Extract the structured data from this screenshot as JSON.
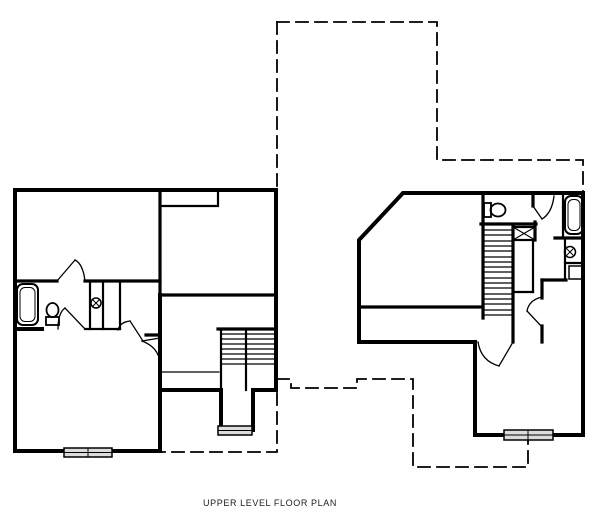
{
  "title": {
    "label": "UPPER LEVEL FLOOR PLAN"
  },
  "canvas": {
    "width": 600,
    "height": 528,
    "background": "#ffffff",
    "line_color": "#000000",
    "window_fill": "#dcdcdc"
  },
  "drawing": {
    "layers": [
      {
        "name": "lower-level-dashed-outline",
        "stroke": "#000000",
        "width": 1.8,
        "dash": "12 7",
        "items": [
          {
            "d": "M277,22 H437 V160 H583 V192"
          },
          {
            "d": "M277,22 V189"
          },
          {
            "d": "M277,379 H291 V388 H357 V379 H413 V467 H528 V441"
          },
          {
            "d": "M277,393 V452 H162"
          }
        ]
      },
      {
        "name": "exterior-walls",
        "stroke": "#000000",
        "width": 4,
        "items": [
          {
            "d": "M15,190 H276 V390 H253"
          },
          {
            "d": "M253,390 V430"
          },
          {
            "d": "M221,390 V430"
          },
          {
            "d": "M219,390 H160"
          },
          {
            "d": "M160,295 V451"
          },
          {
            "d": "M160,451 H15 V190"
          },
          {
            "d": "M403,193 L583,193 L583,435 L475,435 L475,342 L359,342 L359,240 Z"
          },
          {
            "d": "M15,329 H42"
          }
        ]
      },
      {
        "name": "interior-walls",
        "stroke": "#000000",
        "width": 3.2,
        "items": [
          {
            "d": "M160,190 V338"
          },
          {
            "d": "M160,295 H276"
          },
          {
            "d": "M15,281 H57"
          },
          {
            "d": "M85,281 H160"
          },
          {
            "d": "M218,329 H276"
          },
          {
            "d": "M146,335 H160"
          },
          {
            "d": "M481,224 H536"
          },
          {
            "d": "M483,193 V318"
          },
          {
            "d": "M513,227 V342"
          },
          {
            "d": "M359,307 H483"
          },
          {
            "d": "M542,280 V298"
          },
          {
            "d": "M542,326 V342"
          },
          {
            "d": "M542,280 H566"
          },
          {
            "d": "M555,238 H583"
          },
          {
            "d": "M533,193 V206"
          },
          {
            "d": "M535,222 V240"
          }
        ]
      },
      {
        "name": "partition-walls",
        "stroke": "#000000",
        "width": 2.2,
        "items": [
          {
            "d": "M162,206 H218 V193"
          },
          {
            "d": "M90,281 V329"
          },
          {
            "d": "M103,281 V329"
          },
          {
            "d": "M120,281 V329"
          },
          {
            "d": "M85,329 H120"
          },
          {
            "d": "M221,329 V390"
          },
          {
            "d": "M246,329 V390"
          },
          {
            "d": "M563,195 V237"
          },
          {
            "d": "M565,240 V280"
          },
          {
            "d": "M565,263 H583"
          },
          {
            "d": "M533,240 V292"
          },
          {
            "d": "M513,292 H533"
          }
        ]
      },
      {
        "name": "stair-treads",
        "stroke": "#000000",
        "width": 1.2,
        "items": [
          {
            "d": "M221,334 H246"
          },
          {
            "d": "M221,339 H246"
          },
          {
            "d": "M221,344 H246"
          },
          {
            "d": "M221,349 H246"
          },
          {
            "d": "M221,354 H246"
          },
          {
            "d": "M221,359 H246"
          },
          {
            "d": "M221,364 H246"
          },
          {
            "d": "M246,334 H276"
          },
          {
            "d": "M246,339 H276"
          },
          {
            "d": "M246,344 H276"
          },
          {
            "d": "M246,349 H276"
          },
          {
            "d": "M246,354 H276"
          },
          {
            "d": "M246,359 H276"
          },
          {
            "d": "M246,364 H276"
          },
          {
            "d": "M162,372 H219"
          },
          {
            "d": "M483,230 H513"
          },
          {
            "d": "M483,235 H513"
          },
          {
            "d": "M483,241 H513"
          },
          {
            "d": "M483,246 H513"
          },
          {
            "d": "M483,251 H513"
          },
          {
            "d": "M483,257 H513"
          },
          {
            "d": "M483,262 H513"
          },
          {
            "d": "M483,267 H513"
          },
          {
            "d": "M483,272 H513"
          },
          {
            "d": "M483,278 H513"
          },
          {
            "d": "M483,283 H513"
          },
          {
            "d": "M483,288 H513"
          },
          {
            "d": "M483,294 H513"
          },
          {
            "d": "M483,299 H513"
          },
          {
            "d": "M483,304 H513"
          },
          {
            "d": "M483,310 H513"
          },
          {
            "d": "M483,315 H513"
          }
        ]
      },
      {
        "name": "door-swings",
        "stroke": "#000000",
        "width": 1.3,
        "items": [
          {
            "d": "M57,281 L75,260"
          },
          {
            "d": "M75,260 Q83,264 85,281"
          },
          {
            "d": "M85,329 L65,308"
          },
          {
            "d": "M65,308 Q58,313 58,329"
          },
          {
            "d": "M118,330 Q120,322 130,321"
          },
          {
            "d": "M130,321 L143,341"
          },
          {
            "d": "M160,338 L142,341"
          },
          {
            "d": "M142,341 Q158,347 160,362"
          },
          {
            "d": "M478,342 Q481,361 499,366"
          },
          {
            "d": "M499,366 L513,342"
          },
          {
            "d": "M542,297 Q529,300 527,311"
          },
          {
            "d": "M527,311 L542,327"
          },
          {
            "d": "M533,206 L542,219"
          },
          {
            "d": "M542,219 Q552,213 554,196"
          }
        ]
      },
      {
        "name": "attic-access-x-box",
        "stroke": "#000000",
        "width": 2.2,
        "items": [
          {
            "kind": "rect",
            "x": 513,
            "y": 227,
            "w": 22,
            "h": 13
          },
          {
            "d": "M513,227 L535,240",
            "width": 1.1
          },
          {
            "d": "M513,240 L535,227",
            "width": 1.1
          }
        ]
      },
      {
        "name": "bath-fixtures",
        "stroke": "#000000",
        "width": 2,
        "items": [
          {
            "kind": "rect",
            "x": 17,
            "y": 284,
            "w": 21,
            "h": 41,
            "rx": 6
          },
          {
            "kind": "rect",
            "x": 20,
            "y": 287.5,
            "w": 15,
            "h": 34,
            "rx": 5,
            "width": 1
          },
          {
            "kind": "rect",
            "x": 565,
            "y": 196,
            "w": 18,
            "h": 38,
            "rx": 6
          },
          {
            "kind": "rect",
            "x": 568,
            "y": 199.5,
            "w": 12,
            "h": 31,
            "rx": 5,
            "width": 1
          },
          {
            "kind": "rect",
            "x": 46,
            "y": 317,
            "w": 13,
            "h": 8,
            "width": 1.8
          },
          {
            "kind": "ellipse",
            "cx": 52.5,
            "cy": 310,
            "rx": 6,
            "ry": 7,
            "width": 1.8
          },
          {
            "kind": "rect",
            "x": 484,
            "y": 203,
            "w": 7,
            "h": 14,
            "width": 1.8
          },
          {
            "kind": "ellipse",
            "cx": 498,
            "cy": 210,
            "rx": 7.5,
            "ry": 6.5,
            "width": 1.8
          },
          {
            "kind": "circle",
            "cx": 96,
            "cy": 303,
            "r": 5,
            "width": 1.5
          },
          {
            "d": "M93,300 L99,306",
            "width": 1
          },
          {
            "d": "M99,300 L93,306",
            "width": 1
          },
          {
            "kind": "circle",
            "cx": 570,
            "cy": 252,
            "r": 5.5,
            "width": 1.5
          },
          {
            "d": "M567,249 L573,255",
            "width": 1
          },
          {
            "d": "M573,249 L567,255",
            "width": 1
          },
          {
            "kind": "rect",
            "x": 569,
            "y": 266,
            "w": 13,
            "h": 13,
            "width": 1.5
          }
        ]
      },
      {
        "name": "windows",
        "stroke": "#000000",
        "width": 1.5,
        "items": [
          {
            "kind": "rect",
            "x": 64,
            "y": 448,
            "w": 48,
            "h": 9,
            "fill": "#dcdcdc"
          },
          {
            "d": "M64,452.5 H112",
            "width": 1
          },
          {
            "d": "M88,448 V457",
            "width": 1
          },
          {
            "kind": "rect",
            "x": 218,
            "y": 426,
            "w": 34,
            "h": 9,
            "fill": "#dcdcdc"
          },
          {
            "d": "M218,430.5 H252",
            "width": 1
          },
          {
            "kind": "rect",
            "x": 504,
            "y": 430,
            "w": 49,
            "h": 10,
            "fill": "#dcdcdc"
          },
          {
            "d": "M504,435 H553",
            "width": 1
          },
          {
            "d": "M528,430 V440",
            "width": 1
          }
        ]
      }
    ]
  }
}
